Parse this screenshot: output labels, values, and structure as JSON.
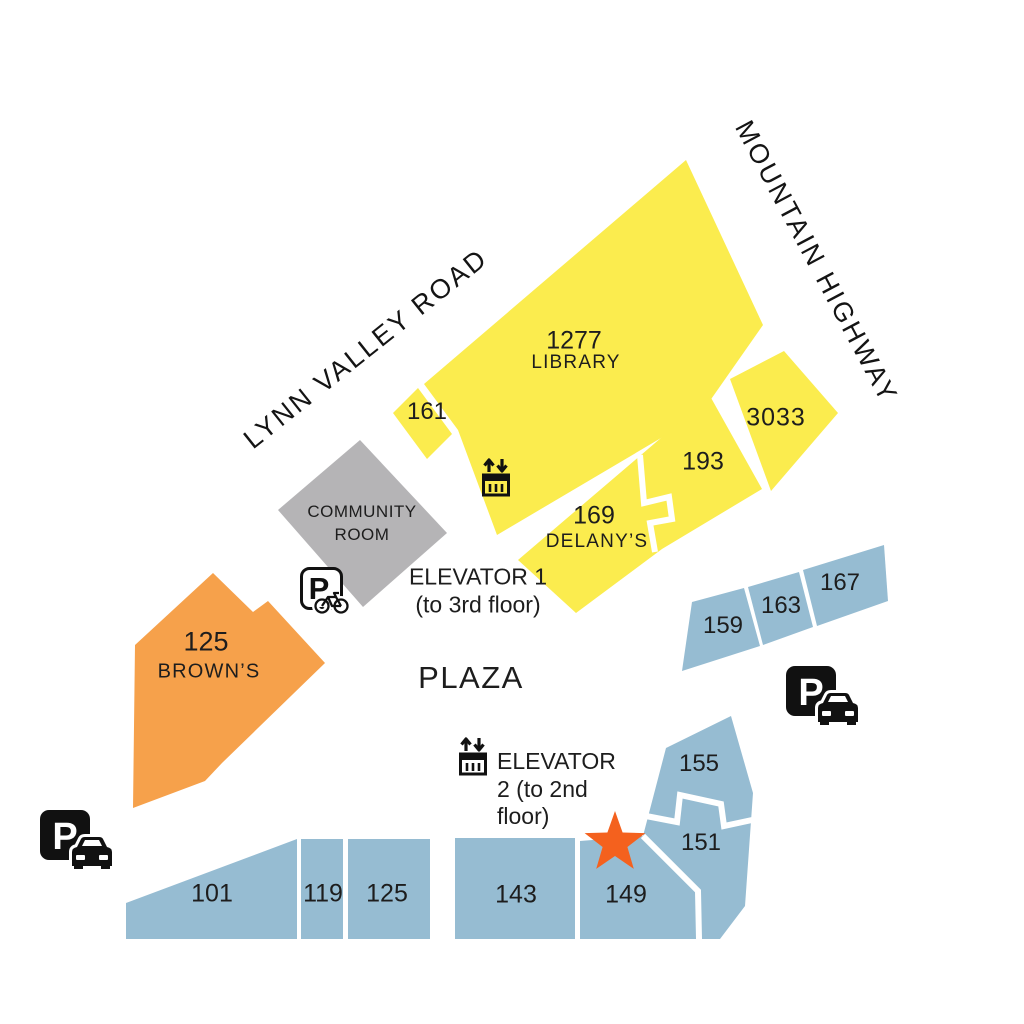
{
  "colors": {
    "building_yellow": "#FBEC4E",
    "building_blue": "#96BCD2",
    "building_orange": "#F6A14B",
    "building_gray": "#B5B4B6",
    "star_orange": "#F4611E",
    "icon_black": "#111111"
  },
  "streets": {
    "lynn_valley_road": "LYNN VALLEY ROAD",
    "mountain_highway": "MOUNTAIN HIGHWAY"
  },
  "plaza_label": "PLAZA",
  "buildings": {
    "library": {
      "number": "1277",
      "name": "LIBRARY"
    },
    "b161": {
      "number": "161"
    },
    "b193": {
      "number": "193"
    },
    "b3033": {
      "number": "3033"
    },
    "b169": {
      "number": "169",
      "name": "DELANY’S"
    },
    "community_room": {
      "name": "COMMUNITY ROOM"
    },
    "browns": {
      "number": "125",
      "name": "BROWN’S"
    },
    "b159": {
      "number": "159"
    },
    "b163": {
      "number": "163"
    },
    "b167": {
      "number": "167"
    },
    "b155": {
      "number": "155"
    },
    "b151": {
      "number": "151"
    },
    "b149": {
      "number": "149"
    },
    "b143": {
      "number": "143"
    },
    "b125": {
      "number": "125"
    },
    "b119": {
      "number": "119"
    },
    "b101": {
      "number": "101"
    }
  },
  "elevators": {
    "elevator1": {
      "label": "ELEVATOR 1 (to 3rd floor)"
    },
    "elevator2": {
      "label": "ELEVATOR 2 (to 2nd floor)"
    }
  },
  "parking": {
    "symbol": "P"
  },
  "marker": {
    "shape": "star"
  }
}
